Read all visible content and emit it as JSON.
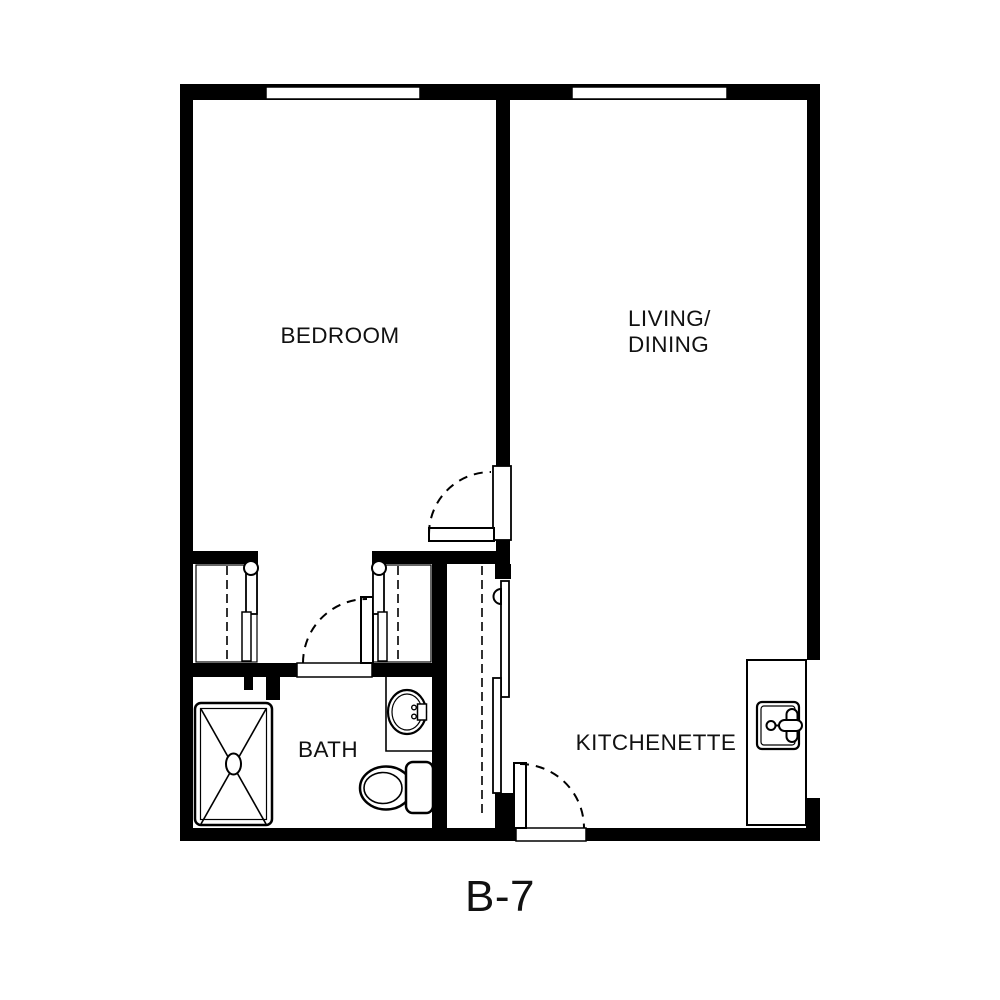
{
  "plan": {
    "title": "B-7",
    "rooms": {
      "bedroom": "BEDROOM",
      "living_line1": "LIVING/",
      "living_line2": "DINING",
      "bath": "BATH",
      "kitchenette": "KITCHENETTE"
    },
    "colors": {
      "ink": "#000000",
      "background": "#ffffff"
    }
  }
}
